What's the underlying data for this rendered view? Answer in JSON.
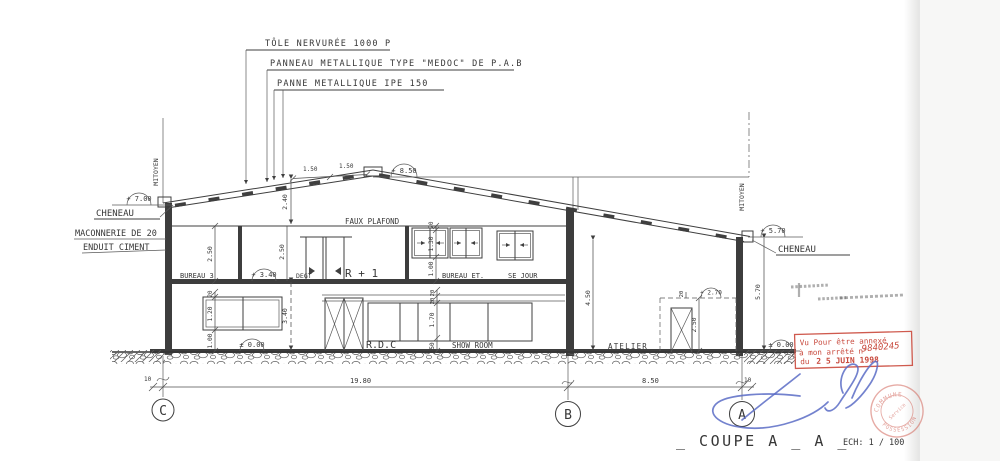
{
  "page": {
    "title": "_ COUPE  A _ A _",
    "scale": "ECH: 1 / 100"
  },
  "annotations": {
    "tole": "TÔLE  NERVURÉE  1000 P",
    "panneau": "PANNEAU  METALLIQUE  TYPE  \"MEDOC\" DE  P.A.B",
    "panne": "PANNE  METALLIQUE   IPE  150",
    "cheneau_left": "CHENEAU",
    "cheneau_right": "CHENEAU",
    "maconnerie": "MACONNERIE  DE 20",
    "enduit": "ENDUIT  CIMENT",
    "mitoyen_left": "MITOYEN",
    "mitoyen_right": "MITOYEN",
    "faux_plafond": "FAUX  PLAFOND"
  },
  "levels": {
    "ridge": "+ 8.50",
    "eave_left": "+ 7.00",
    "eave_right": "+ 5.70",
    "floor1": "+ 3.40",
    "ground_left": "± 0.00",
    "ground_right": "± 0.00",
    "atelier_top": "+ 2.70"
  },
  "rooms": {
    "bureau3": "BUREAU 3",
    "degt": "DEGT",
    "r1": "R + 1",
    "bureau_et": "BUREAU ET.",
    "sejour": "SE JOUR",
    "rdc": "R.D.C",
    "showroom": "SHOW  ROOM",
    "atelier": "ATELIER"
  },
  "dims": {
    "ridge_bay1": "1.50",
    "ridge_bay2": "1.50",
    "roof_rise": "2.40",
    "r1_height_a": "2.50",
    "r1_height_b": "2.50",
    "r1_lintel": "20",
    "r1_window": "1.30",
    "r1_sill": "1.00",
    "rdc_lintel": "20",
    "rdc_window": "1.20",
    "rdc_sill": "1.00",
    "rdc_height": "3.40",
    "sr_band_a": "20",
    "sr_band_b": "20",
    "sr_window": "1.70",
    "sr_sill": "50",
    "atelier_height": "4.50",
    "door_lintel": "20",
    "door_height": "2.50",
    "wall_right_height": "5.70",
    "span_cb": "19.80",
    "span_ba": "8.50",
    "offset_left": "10",
    "offset_right": "10"
  },
  "grid": {
    "c": "C",
    "b": "B",
    "a": "A"
  },
  "stamp": {
    "line1": "Vu Pour être annexé",
    "line2": "à mon arrêté n°",
    "number": "9840245",
    "line3": "du",
    "date": "2 5 JUIN 1998"
  },
  "seal": {
    "top": "COMMUNE",
    "bottom": "POSSESSION",
    "inner": "Service"
  },
  "colors": {
    "ink": "#3f3f3f",
    "stamp_red": "#c8493d",
    "signature_blue": "#5b6cc6"
  }
}
